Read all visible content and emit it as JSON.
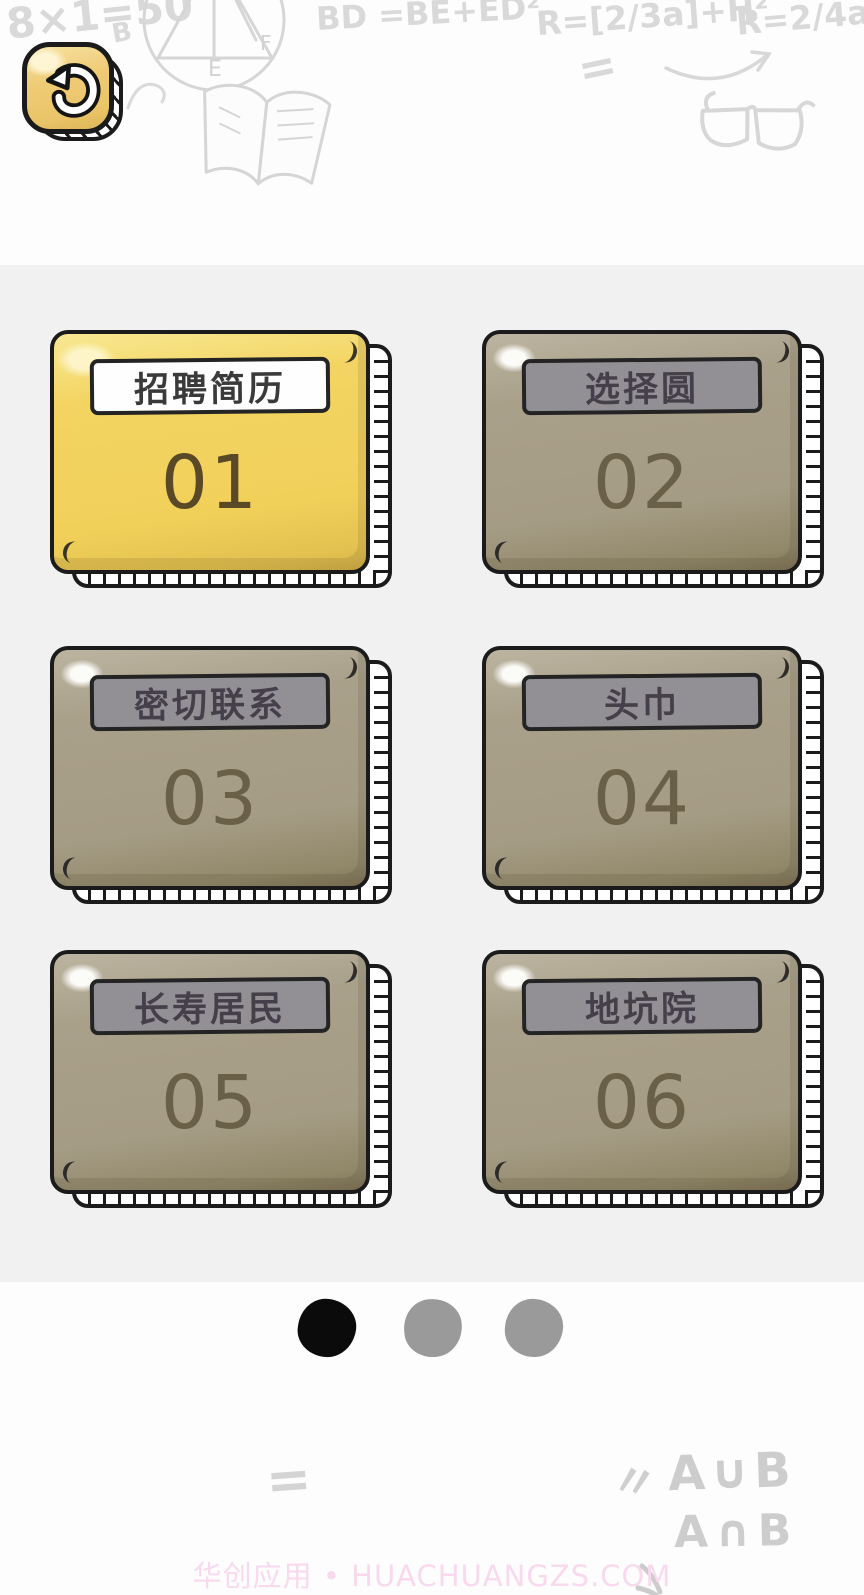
{
  "back_button": {
    "icon": "undo-arrow"
  },
  "levels": [
    {
      "number": "01",
      "name": "招聘简历",
      "state": "active"
    },
    {
      "number": "02",
      "name": "选择圆",
      "state": "locked"
    },
    {
      "number": "03",
      "name": "密切联系",
      "state": "locked"
    },
    {
      "number": "04",
      "name": "头巾",
      "state": "locked"
    },
    {
      "number": "05",
      "name": "长寿居民",
      "state": "locked"
    },
    {
      "number": "06",
      "name": "地坑院",
      "state": "locked"
    }
  ],
  "pagination": {
    "count": 3,
    "active_index": 0
  },
  "watermark": {
    "text": "华创应用 • HUACHUANGZS.COM"
  },
  "doodles": {
    "formula_left": "8×1=50",
    "formula_left_sub": "B",
    "formula_bd": "BD =BE+ED²",
    "formula_r1": "R=[2/3a]+H²",
    "formula_r2": "R=2/4a",
    "equals_top": "=",
    "label_e": "E",
    "label_f": "F",
    "equals_bottom": "=",
    "quote_marks": "〃",
    "set_union": "A∪B",
    "set_intersection": "A∩B"
  },
  "colors": {
    "band_gray": "#f1f1f2",
    "card_active_yellow": "#f3d462",
    "card_locked_khaki": "#a9a08a",
    "card_outline": "#1b1b1b",
    "label_locked_gray": "#929095",
    "active_number": "#5a4927",
    "locked_number": "#6a6047",
    "dot_active": "#0b0b0b",
    "dot_inactive": "#9a9a9a",
    "watermark_pink": "#f8d9ee",
    "doodle_gray": "#d9d9d9",
    "button_yellow": "#efcb76"
  }
}
